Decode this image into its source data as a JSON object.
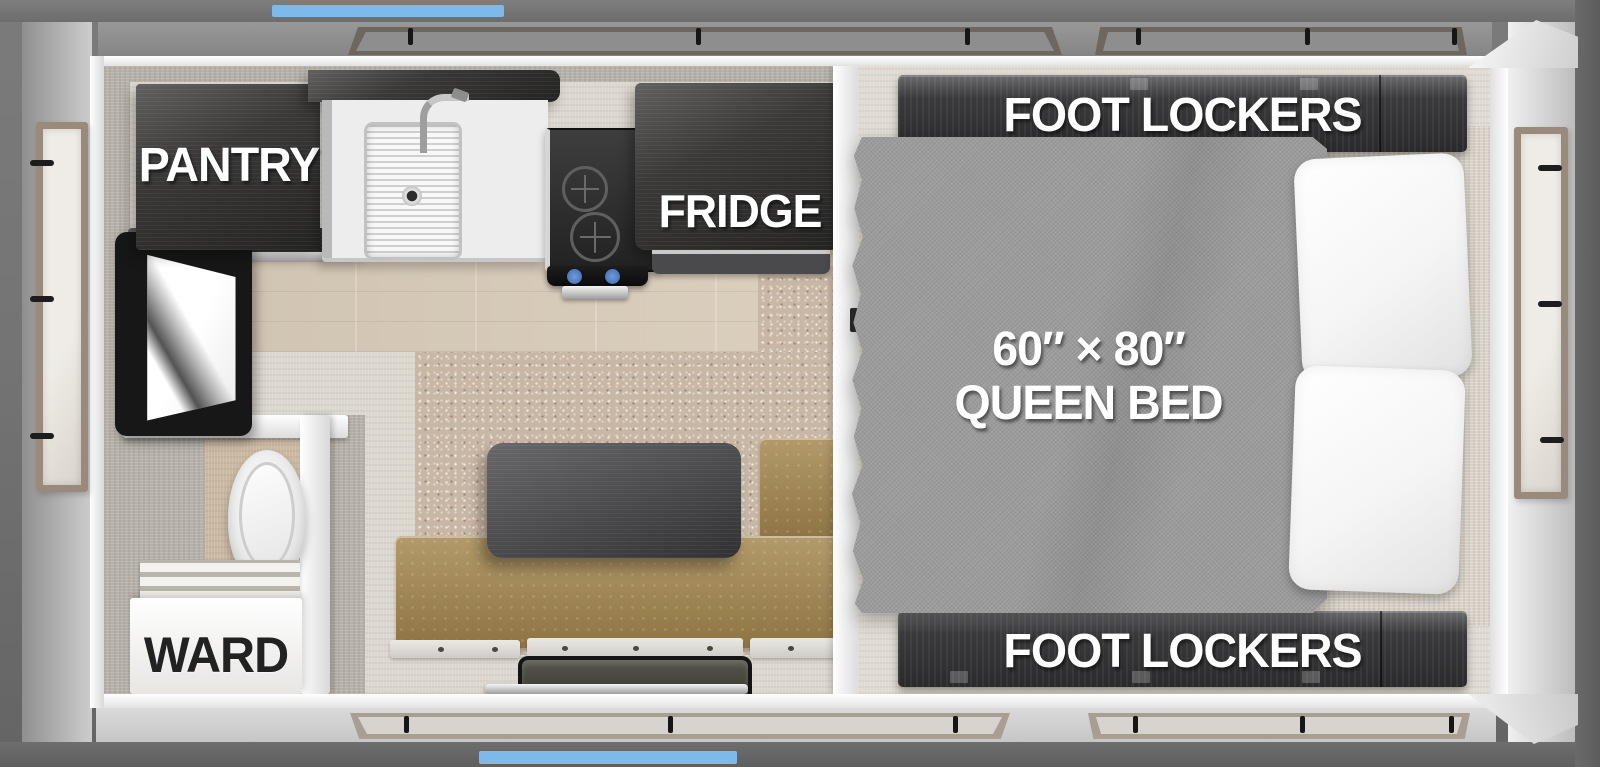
{
  "floorplan": {
    "labels": {
      "pantry": "PANTRY",
      "fridge": "FRIDGE",
      "ward": "WARD",
      "foot_lockers_top": "FOOT LOCKERS",
      "foot_lockers_bottom": "FOOT LOCKERS",
      "bed_size": "60″ × 80″",
      "bed_type": "QUEEN BED"
    },
    "colors": {
      "accent_blue": "#7DB9E9",
      "cabinet_charcoal": "#3A3A3C",
      "bench_leather": "#A5874E",
      "bed_fabric_gray": "#9C9C9C",
      "carpet_beige": "#C9B7A6",
      "wood_floor": "#D9CCBA",
      "wall_greige": "#B6B1A9",
      "frame_gray": "#747474"
    }
  }
}
